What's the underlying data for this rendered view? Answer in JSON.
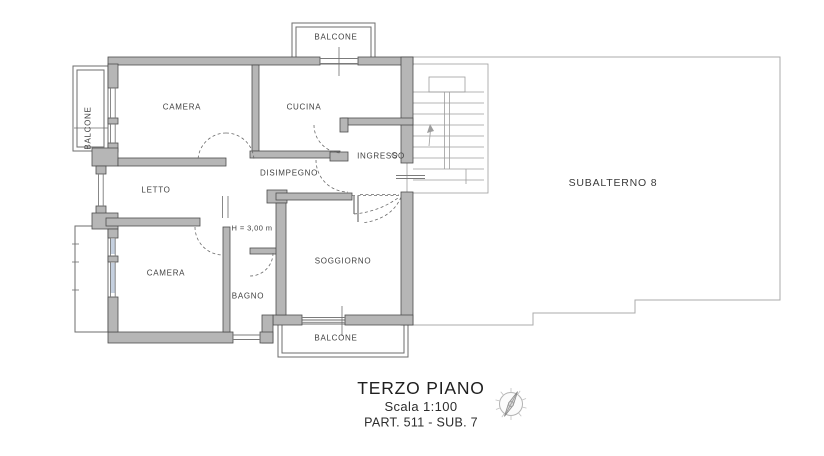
{
  "plan": {
    "rooms": {
      "camera_top": "CAMERA",
      "cucina": "CUCINA",
      "ingresso": "INGRESSO",
      "disimpegno": "DISIMPEGNO",
      "letto": "LETTO",
      "camera_bottom": "CAMERA",
      "bagno": "BAGNO",
      "soggiorno": "SOGGIORNO"
    },
    "balconies": {
      "top": "BALCONE",
      "left": "BALCONE",
      "bottom": "BALCONE"
    },
    "notes": {
      "ceiling_height": "H = 3,00 m",
      "adjacent_unit": "SUBALTERNO 8"
    },
    "colors": {
      "wall_fill": "#b6b6b6",
      "wall_stroke": "#4d4d4d",
      "thin_line": "#7b7b7b",
      "boundary_line": "#ababab",
      "label_text": "#414141",
      "title_text": "#202020"
    }
  },
  "title_block": {
    "floor": "TERZO PIANO",
    "scale": "Scala 1:100",
    "cadastral": "PART. 511 - SUB. 7"
  },
  "icons": {
    "compass": "compass-rose-icon"
  }
}
